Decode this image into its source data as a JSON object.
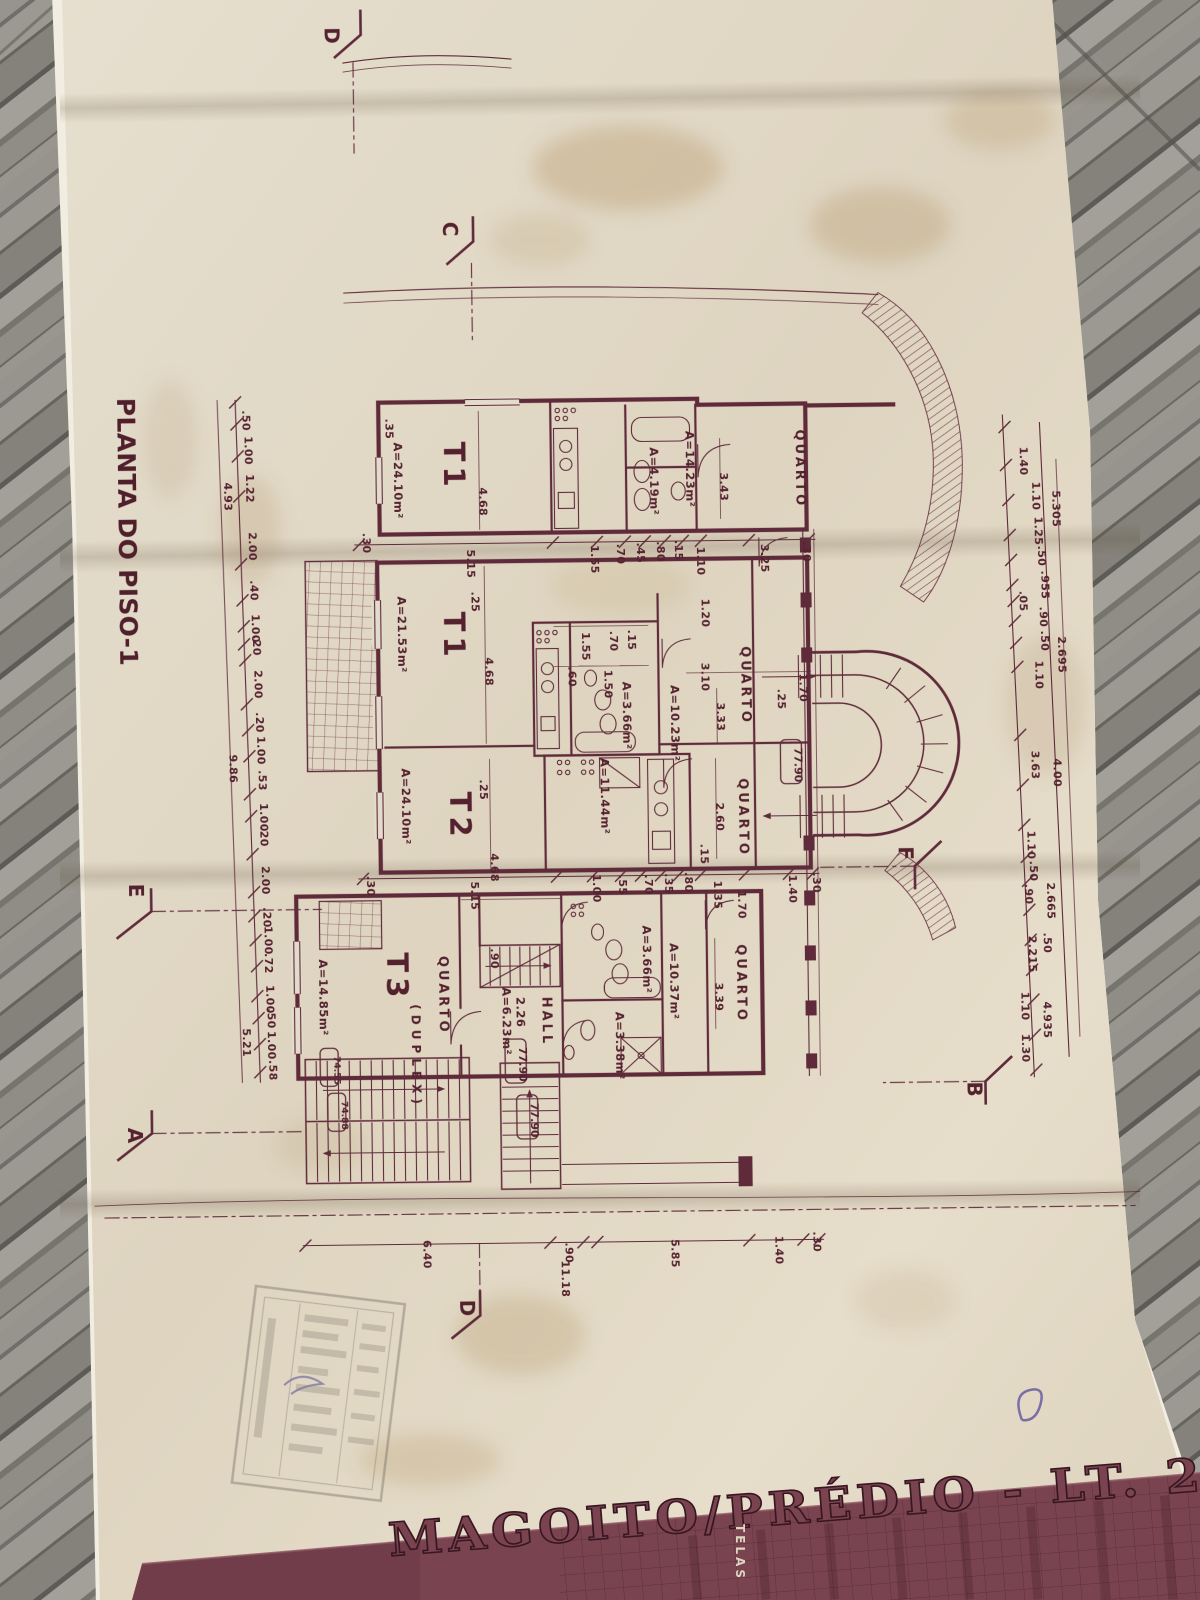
{
  "scene": {
    "ink_color": "#5f2b3a",
    "paper_color": "#e3dccb",
    "band_color": "#7a4350",
    "wood_color": "#8d8c86"
  },
  "plan": {
    "title": "PLANTA DO PISO-1",
    "units": [
      {
        "t": "T1",
        "x": 448,
        "y": 440
      },
      {
        "t": "T1",
        "x": 446,
        "y": 610
      },
      {
        "t": "T2",
        "x": 450,
        "y": 790
      },
      {
        "t": "T3",
        "x": 385,
        "y": 950
      },
      {
        "t": "(DUPLEX)",
        "x": 409,
        "y": 1002,
        "s": 12
      }
    ],
    "rooms": [
      {
        "t": "QUARTO",
        "x": 800,
        "y": 432
      },
      {
        "t": "QUARTO",
        "x": 743,
        "y": 648
      },
      {
        "t": "QUARTO",
        "x": 739,
        "y": 780
      },
      {
        "t": "QUARTO",
        "x": 437,
        "y": 954
      },
      {
        "t": "QUARTO",
        "x": 735,
        "y": 946
      },
      {
        "t": "HALL",
        "x": 540,
        "y": 996
      }
    ],
    "areas": [
      {
        "t": "A=24.10m²",
        "x": 398,
        "y": 440
      },
      {
        "t": "A=14.23m²",
        "x": 690,
        "y": 432
      },
      {
        "t": "A=4.19m²",
        "x": 654,
        "y": 448
      },
      {
        "t": "A=21.53m²",
        "x": 400,
        "y": 594
      },
      {
        "t": "A=10.23m²",
        "x": 672,
        "y": 686
      },
      {
        "t": "A=3.66m²",
        "x": 624,
        "y": 682
      },
      {
        "t": "A=11.44m²",
        "x": 601,
        "y": 758
      },
      {
        "t": "A=24.10m²",
        "x": 402,
        "y": 766
      },
      {
        "t": "A=14.85m²",
        "x": 317,
        "y": 956
      },
      {
        "t": "A=6.23m²",
        "x": 500,
        "y": 986
      },
      {
        "t": "2.26",
        "x": 514,
        "y": 996
      },
      {
        "t": "A=3.66m²",
        "x": 641,
        "y": 926
      },
      {
        "t": "A=10.37m²",
        "x": 668,
        "y": 944
      },
      {
        "t": "A=3.38m²",
        "x": 613,
        "y": 1012
      }
    ],
    "levels": [
      {
        "t": "77.90",
        "x": 795,
        "y": 750,
        "w": 21,
        "h": 44
      },
      {
        "t": "77.90",
        "x": 516,
        "y": 1046,
        "w": 21,
        "h": 44
      },
      {
        "t": "77.90",
        "x": 527,
        "y": 1102,
        "w": 21,
        "h": 44
      },
      {
        "t": "74.55",
        "x": 331,
        "y": 1053,
        "w": 18,
        "h": 38,
        "s": 9
      },
      {
        "t": "74.88",
        "x": 338,
        "y": 1098,
        "w": 18,
        "h": 38,
        "s": 9
      }
    ],
    "sections": [
      {
        "t": "D",
        "x": 334,
        "y": 24
      },
      {
        "t": "C",
        "x": 450,
        "y": 220
      },
      {
        "t": "E",
        "x": 128,
        "y": 878
      },
      {
        "t": "A",
        "x": 124,
        "y": 1122
      },
      {
        "t": "F",
        "x": 898,
        "y": 850
      },
      {
        "t": "B",
        "x": 964,
        "y": 1086
      },
      {
        "t": "D",
        "x": 454,
        "y": 1298
      }
    ],
    "dim_labels": [
      {
        "t": ".30",
        "x": 366,
        "y": 530
      },
      {
        "t": "5.15",
        "x": 470,
        "y": 548
      },
      {
        "t": "1.55",
        "x": 594,
        "y": 545
      },
      {
        "t": ".70",
        "x": 620,
        "y": 544
      },
      {
        "t": ".45",
        "x": 640,
        "y": 543
      },
      {
        "t": ".80",
        "x": 660,
        "y": 542
      },
      {
        "t": ".15",
        "x": 678,
        "y": 541
      },
      {
        "t": "1.10",
        "x": 700,
        "y": 548
      },
      {
        "t": "3.25",
        "x": 764,
        "y": 546
      },
      {
        "t": ".30",
        "x": 806,
        "y": 544
      },
      {
        "t": "3.43",
        "x": 724,
        "y": 474
      },
      {
        "t": ".35",
        "x": 390,
        "y": 416
      },
      {
        "t": "4.68",
        "x": 483,
        "y": 486
      },
      {
        "t": "1.55",
        "x": 584,
        "y": 632
      },
      {
        "t": ".70",
        "x": 612,
        "y": 631
      },
      {
        "t": ".15",
        "x": 630,
        "y": 630
      },
      {
        "t": ".60",
        "x": 570,
        "y": 666
      },
      {
        "t": "1.50",
        "x": 606,
        "y": 670
      },
      {
        "t": "3.10",
        "x": 703,
        "y": 664
      },
      {
        "t": "1.20",
        "x": 704,
        "y": 600
      },
      {
        "t": "3.33",
        "x": 718,
        "y": 704
      },
      {
        "t": "1.70",
        "x": 801,
        "y": 676
      },
      {
        "t": ".25",
        "x": 779,
        "y": 691
      },
      {
        "t": "4.68",
        "x": 487,
        "y": 656
      },
      {
        "t": ".25",
        "x": 474,
        "y": 590
      },
      {
        "t": "2.60",
        "x": 716,
        "y": 804
      },
      {
        "t": ".25",
        "x": 480,
        "y": 778
      },
      {
        "t": "4.68",
        "x": 490,
        "y": 852
      },
      {
        "t": "1.35",
        "x": 713,
        "y": 882
      },
      {
        "t": ".30",
        "x": 366,
        "y": 873
      },
      {
        "t": "5.15",
        "x": 470,
        "y": 880
      },
      {
        "t": "1.00",
        "x": 592,
        "y": 874
      },
      {
        "t": ".55",
        "x": 618,
        "y": 875
      },
      {
        "t": ".70",
        "x": 644,
        "y": 875
      },
      {
        "t": ".35",
        "x": 664,
        "y": 874
      },
      {
        "t": ".80",
        "x": 684,
        "y": 873
      },
      {
        "t": "1.70",
        "x": 737,
        "y": 892
      },
      {
        "t": "1.40",
        "x": 788,
        "y": 877
      },
      {
        "t": ".30",
        "x": 812,
        "y": 875
      },
      {
        "t": ".90",
        "x": 489,
        "y": 947
      },
      {
        "t": "3.39",
        "x": 713,
        "y": 984
      },
      {
        "t": ".15",
        "x": 700,
        "y": 845
      },
      {
        "t": "6.40",
        "x": 418,
        "y": 1238
      },
      {
        "t": ".90",
        "x": 560,
        "y": 1242
      },
      {
        "t": "5.85",
        "x": 666,
        "y": 1240
      },
      {
        "t": "1.40",
        "x": 770,
        "y": 1238
      },
      {
        "t": ".30",
        "x": 808,
        "y": 1234
      },
      {
        "t": "11.18",
        "x": 556,
        "y": 1260
      },
      {
        "t": ".50",
        "x": 247,
        "y": 406
      },
      {
        "t": "1.00",
        "x": 249,
        "y": 432
      },
      {
        "t": "1.22",
        "x": 250,
        "y": 470
      },
      {
        "t": "4.93",
        "x": 228,
        "y": 478
      },
      {
        "t": "2.00",
        "x": 252,
        "y": 528
      },
      {
        "t": ".40",
        "x": 253,
        "y": 576
      },
      {
        "t": "1.00",
        "x": 254,
        "y": 610
      },
      {
        "t": ".20",
        "x": 255,
        "y": 631
      },
      {
        "t": "2.00",
        "x": 256,
        "y": 666
      },
      {
        "t": ".20",
        "x": 257,
        "y": 708
      },
      {
        "t": "1.00",
        "x": 258,
        "y": 732
      },
      {
        "t": ".53",
        "x": 259,
        "y": 766
      },
      {
        "t": "1.00",
        "x": 260,
        "y": 799
      },
      {
        "t": ".20",
        "x": 260,
        "y": 822
      },
      {
        "t": "2.00",
        "x": 261,
        "y": 862
      },
      {
        "t": "9.86",
        "x": 230,
        "y": 750
      },
      {
        "t": ".20",
        "x": 262,
        "y": 903
      },
      {
        "t": "1.00",
        "x": 263,
        "y": 922
      },
      {
        "t": ".72",
        "x": 263,
        "y": 949
      },
      {
        "t": "1.00",
        "x": 264,
        "y": 981
      },
      {
        "t": ".50",
        "x": 265,
        "y": 1004
      },
      {
        "t": "1.00",
        "x": 265,
        "y": 1027
      },
      {
        "t": ".58",
        "x": 266,
        "y": 1056
      },
      {
        "t": "5.21",
        "x": 240,
        "y": 1024
      },
      {
        "t": "1.40",
        "x": 1024,
        "y": 452
      },
      {
        "t": "1.10",
        "x": 1036,
        "y": 487
      },
      {
        "t": "5.305",
        "x": 1056,
        "y": 496
      },
      {
        "t": "1.25",
        "x": 1038,
        "y": 522
      },
      {
        "t": ".50",
        "x": 1041,
        "y": 551
      },
      {
        "t": ".955",
        "x": 1044,
        "y": 576
      },
      {
        "t": ".05",
        "x": 1022,
        "y": 596
      },
      {
        "t": ".90",
        "x": 1042,
        "y": 612
      },
      {
        "t": ".50",
        "x": 1043,
        "y": 636
      },
      {
        "t": "1.10",
        "x": 1037,
        "y": 666
      },
      {
        "t": "2.695",
        "x": 1060,
        "y": 642
      },
      {
        "t": "3.63",
        "x": 1032,
        "y": 756
      },
      {
        "t": "4.00",
        "x": 1054,
        "y": 764
      },
      {
        "t": "1.10",
        "x": 1027,
        "y": 836
      },
      {
        "t": ".50",
        "x": 1029,
        "y": 866
      },
      {
        "t": ".90",
        "x": 1024,
        "y": 889
      },
      {
        "t": "2.665",
        "x": 1046,
        "y": 888
      },
      {
        "t": "2.215",
        "x": 1027,
        "y": 941
      },
      {
        "t": ".50",
        "x": 1042,
        "y": 938
      },
      {
        "t": "1.10",
        "x": 1019,
        "y": 997
      },
      {
        "t": "4.935",
        "x": 1041,
        "y": 1007
      },
      {
        "t": "1.30",
        "x": 1019,
        "y": 1039
      }
    ],
    "ticks": [
      [
        240,
        398
      ],
      [
        241,
        420
      ],
      [
        242,
        452
      ],
      [
        243,
        492
      ],
      [
        244,
        560
      ],
      [
        245,
        596
      ],
      [
        246,
        622
      ],
      [
        246,
        640
      ],
      [
        247,
        656
      ],
      [
        248,
        700
      ],
      [
        249,
        726
      ],
      [
        250,
        752
      ],
      [
        250,
        790
      ],
      [
        251,
        812
      ],
      [
        252,
        850
      ],
      [
        253,
        888
      ],
      [
        253,
        912
      ],
      [
        254,
        936
      ],
      [
        255,
        962
      ],
      [
        255,
        992
      ],
      [
        256,
        1014
      ],
      [
        257,
        1040
      ],
      [
        257,
        1068
      ],
      [
        1009,
        432
      ],
      [
        1010,
        470
      ],
      [
        1012,
        505
      ],
      [
        1013,
        540
      ],
      [
        1014,
        565
      ],
      [
        1015,
        590
      ],
      [
        1016,
        606
      ],
      [
        1017,
        626
      ],
      [
        1018,
        648
      ],
      [
        1019,
        672
      ],
      [
        1021,
        740
      ],
      [
        1023,
        790
      ],
      [
        1024,
        830
      ],
      [
        1026,
        862
      ],
      [
        1027,
        886
      ],
      [
        1028,
        915
      ],
      [
        1029,
        945
      ],
      [
        1030,
        975
      ],
      [
        1031,
        1005
      ],
      [
        1032,
        1040
      ],
      [
        1033,
        1075
      ],
      [
        362,
        542
      ],
      [
        556,
        542
      ],
      [
        600,
        542
      ],
      [
        628,
        542
      ],
      [
        648,
        542
      ],
      [
        668,
        542
      ],
      [
        686,
        542
      ],
      [
        704,
        542
      ],
      [
        752,
        542
      ],
      [
        812,
        542
      ],
      [
        362,
        876
      ],
      [
        556,
        876
      ],
      [
        592,
        876
      ],
      [
        620,
        876
      ],
      [
        640,
        876
      ],
      [
        660,
        876
      ],
      [
        678,
        876
      ],
      [
        700,
        876
      ],
      [
        744,
        876
      ],
      [
        788,
        876
      ],
      [
        812,
        876
      ],
      [
        300,
        1242
      ],
      [
        545,
        1242
      ],
      [
        578,
        1242
      ],
      [
        592,
        1242
      ],
      [
        744,
        1242
      ],
      [
        798,
        1242
      ],
      [
        814,
        1242
      ]
    ]
  },
  "title_band": {
    "title": "MAGOITO/PRÉDIO - LT. 2A",
    "telas": "TELAS"
  }
}
